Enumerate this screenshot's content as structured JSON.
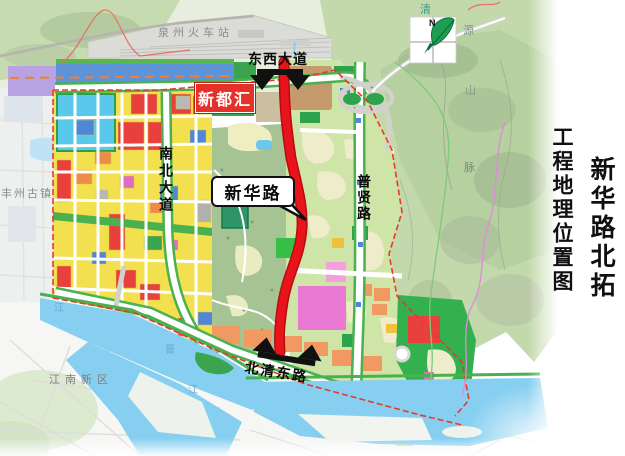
{
  "title": {
    "main_vertical": "新华路北拓",
    "sub_vertical": "工程地理位置图"
  },
  "labels": {
    "railway_station": "泉州火车站",
    "east_west_avenue": "东西大道",
    "xinduhui": "新都汇",
    "north_south_avenue": "南北大道",
    "xinhua_road": "新华路",
    "puxian_road": "普贤路",
    "beiqing_east_road": "北清东路",
    "fengzhou_old_town": "丰州古镇",
    "jiangnan_new_district": "江南新区",
    "mountain_name_chars": [
      "清",
      "源",
      "山",
      "脉"
    ],
    "river_name_chars": [
      "江",
      "晋",
      "江"
    ],
    "compass_north": "N"
  },
  "colors": {
    "highlight_road": "#e8131b",
    "boundary_dash": "#e8392f",
    "parcel_yellow": "#f2e04e",
    "parcel_red": "#e8403c",
    "parcel_green": "#44b04e",
    "parcel_blue": "#4f86d8",
    "parcel_orange": "#ef8b4a",
    "parcel_magenta": "#e06cc0",
    "parcel_cyan": "#59c8ea",
    "water": "#8fd4f2",
    "mountain": "#c3d9ab",
    "label_box_red": "#e43129"
  }
}
